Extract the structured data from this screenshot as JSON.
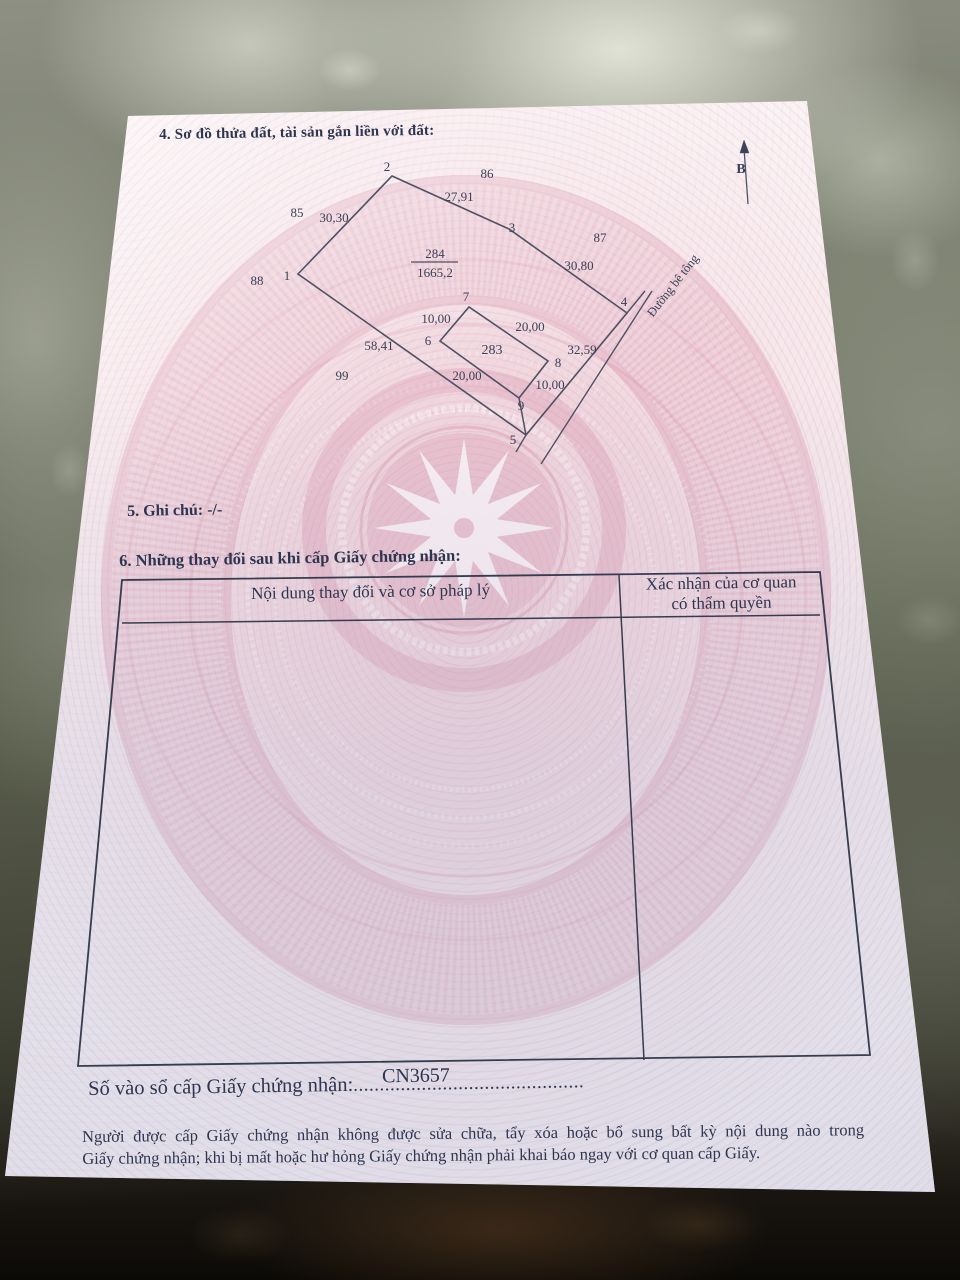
{
  "colors": {
    "ink": "#2e3550",
    "line": "#4d5263",
    "table_border": "#363c50",
    "paper": "#f4e2e7",
    "watermark_pink": "#d588a2"
  },
  "sections": {
    "s4_title": "4. Sơ đồ thửa đất, tài sản gắn liền với đất:",
    "s5_title": "5. Ghi chú: -/-",
    "s6_title": "6. Những thay đổi sau khi cấp Giấy chứng nhận:"
  },
  "table": {
    "col1_header": "Nội dung thay đổi và cơ sở pháp lý",
    "col2_header_line1": "Xác nhận của cơ quan",
    "col2_header_line2": "có thẩm quyền"
  },
  "registry": {
    "label": "Số vào sổ cấp Giấy chứng nhận:",
    "dots": "............................................",
    "number": "CN3657"
  },
  "footer": {
    "line1": "Người được cấp Giấy chứng nhận không được sửa chữa, tẩy xóa hoặc bổ sung bất kỳ nội dung nào trong",
    "line2": "Giấy chứng nhận; khi bị mất hoặc hư hỏng Giấy chứng nhận phải khai báo ngay với cơ quan cấp Giấy."
  },
  "svg": {
    "lines": [
      {
        "n": "parcel-284-boundary",
        "points": "298,274 392,176 509,229 627,313 526,435",
        "closed": true,
        "w": 1.6
      },
      {
        "n": "parcel-283-boundary",
        "points": "440,341 469,307 548,361 519,398",
        "closed": true,
        "w": 1.6
      },
      {
        "n": "tie-line-9-5",
        "points": "519,398 526,435",
        "w": 1.5
      },
      {
        "n": "road-edge-ext-top",
        "points": "627,313 645,291",
        "w": 1.4
      },
      {
        "n": "road-edge-ext-bottom",
        "points": "526,435 516,452",
        "w": 1.4
      },
      {
        "n": "road-far-edge",
        "points": "652,291 541,464",
        "w": 1.4
      },
      {
        "n": "north-arrow-line",
        "points": "748,204 744,148",
        "w": 1.3
      },
      {
        "n": "north-arrow-head",
        "points": "744,140 740,153 749,153",
        "closed": true,
        "fill": "#3b4156",
        "w": 0.5
      },
      {
        "n": "fraction-bar",
        "points": "411,262 458,262",
        "w": 1.2
      },
      {
        "n": "table-outer-border",
        "points": "122,580 820,572 870,1055 78,1066",
        "closed": true,
        "w": 1.8,
        "stroke": "#363c50"
      },
      {
        "n": "table-column-divider",
        "points": "619,575 644,1060",
        "w": 1.5,
        "stroke": "#363c50"
      },
      {
        "n": "table-header-separator",
        "points": "122,623 820,615",
        "w": 1.5,
        "stroke": "#363c50"
      }
    ],
    "labels": [
      {
        "t": "2",
        "x": 387,
        "y": 171
      },
      {
        "t": "86",
        "x": 487,
        "y": 178
      },
      {
        "t": "27,91",
        "x": 459,
        "y": 201
      },
      {
        "t": "85",
        "x": 297,
        "y": 217
      },
      {
        "t": "30,30",
        "x": 334,
        "y": 222
      },
      {
        "t": "3",
        "x": 512,
        "y": 232
      },
      {
        "t": "87",
        "x": 600,
        "y": 242
      },
      {
        "t": "284",
        "x": 435,
        "y": 258
      },
      {
        "t": "1665,2",
        "x": 435,
        "y": 277
      },
      {
        "t": "30,80",
        "x": 579,
        "y": 270
      },
      {
        "t": "1",
        "x": 287,
        "y": 280
      },
      {
        "t": "88",
        "x": 257,
        "y": 285
      },
      {
        "t": "4",
        "x": 624,
        "y": 306
      },
      {
        "t": "Đường bê tông",
        "x": 676,
        "y": 288,
        "r": -52,
        "fs": 12.5
      },
      {
        "t": "7",
        "x": 466,
        "y": 301
      },
      {
        "t": "10,00",
        "x": 436,
        "y": 323
      },
      {
        "t": "20,00",
        "x": 530,
        "y": 331
      },
      {
        "t": "6",
        "x": 428,
        "y": 345
      },
      {
        "t": "283",
        "x": 492,
        "y": 354,
        "fs": 14
      },
      {
        "t": "58,41",
        "x": 379,
        "y": 350
      },
      {
        "t": "32,59",
        "x": 582,
        "y": 354
      },
      {
        "t": "8",
        "x": 558,
        "y": 367
      },
      {
        "t": "99",
        "x": 342,
        "y": 380
      },
      {
        "t": "20,00",
        "x": 467,
        "y": 380
      },
      {
        "t": "10,00",
        "x": 550,
        "y": 389
      },
      {
        "t": "9",
        "x": 521,
        "y": 410
      },
      {
        "t": "5",
        "x": 513,
        "y": 444
      },
      {
        "t": "B",
        "x": 741,
        "y": 173,
        "b": true,
        "fs": 14
      }
    ]
  }
}
